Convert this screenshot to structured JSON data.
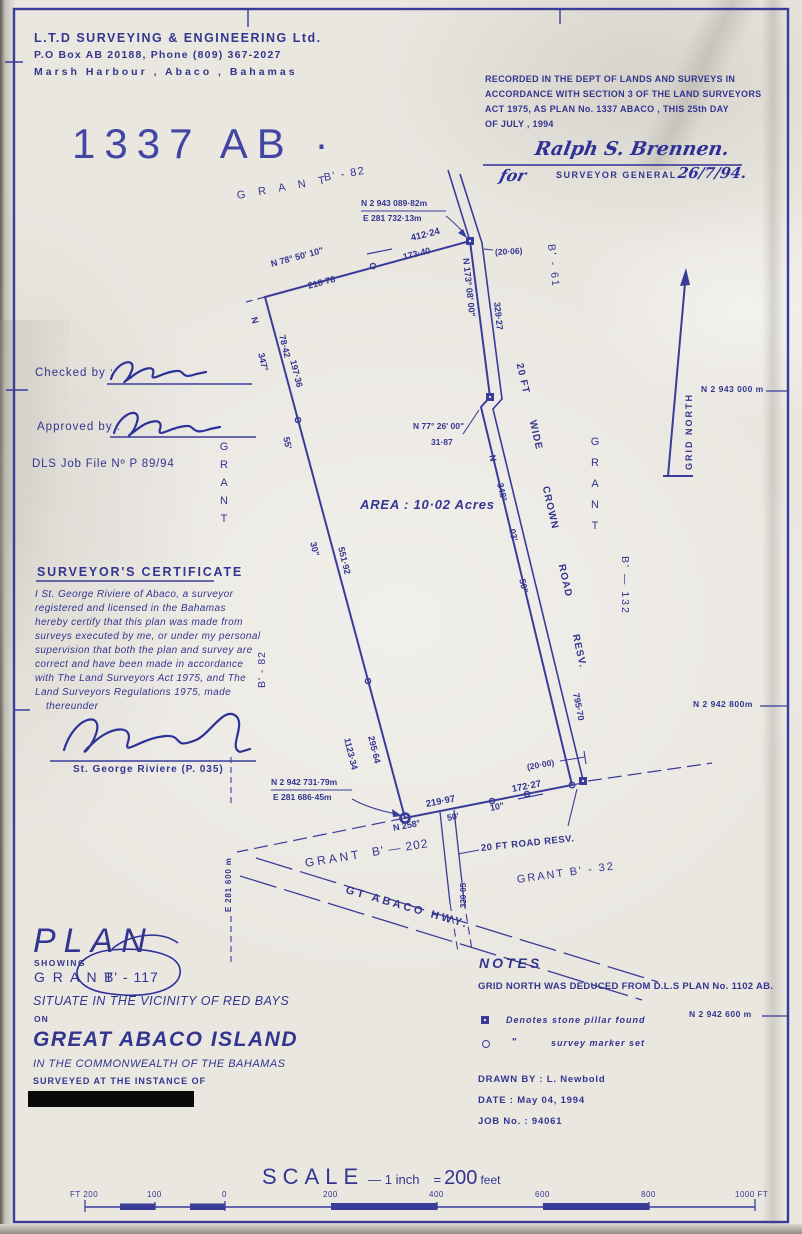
{
  "colors": {
    "ink": "#3a3c9a",
    "text": "#33358f",
    "script": "#2e3198"
  },
  "company": {
    "line1": "L.T.D  SURVEYING  &  ENGINEERING  Ltd.",
    "line2": "P.O Box AB 20188,  Phone  (809) 367-2027",
    "line3": "Marsh  Harbour ,    Abaco   ,   Bahamas"
  },
  "plan_number": "1337 AB ·",
  "recording": {
    "line1": "RECORDED IN THE DEPT  OF LANDS AND SURVEYS  IN",
    "line2": "ACCORDANCE WITH SECTION 3 OF THE LAND SURVEYORS",
    "line3": "ACT 1975, AS PLAN No.  1337    ABACO , THIS 25th DAY",
    "line4": "OF   JULY ,        1994",
    "signature": "Ralph S. Brennen.",
    "for_word": "for",
    "title": "SURVEYOR  GENERAL",
    "date": "26/7/94."
  },
  "approvals": {
    "checked": "Checked by :",
    "approved": "Approved by :",
    "dls": "DLS Job  File Nº  P 89/94"
  },
  "certificate": {
    "title": "SURVEYOR'S  CERTIFICATE",
    "lines": [
      "I St. George Riviere of Abaco, a surveyor",
      "registered and licensed in the Bahamas",
      "hereby certify that this plan was made from",
      "surveys executed by me, or under my personal",
      "supervision that both the plan and survey are",
      "correct and have been made in accordance",
      "with The Land Surveyors Act 1975, and The",
      "Land Surveyors Regulations 1975, made",
      "thereunder"
    ],
    "name": "St. George Riviere  (P. 035)"
  },
  "title_block": {
    "plan": "PLAN",
    "showing": "SHOWING",
    "grant": "G R A N T",
    "grant_no": "B' - 117",
    "situate": "SITUATE IN THE VICINITY OF RED BAYS",
    "on": "ON",
    "island": "GREAT  ABACO  ISLAND",
    "commonwealth": "IN THE COMMONWEALTH  OF THE BAHAMAS",
    "surveyed": "SURVEYED  AT  THE  INSTANCE  OF"
  },
  "notes": {
    "title": "NOTES",
    "line1": "GRID NORTH WAS DEDUCED FROM D.L.S PLAN No. 1102 AB.",
    "legend_pillar": "Denotes stone pillar found",
    "ditto": "\"",
    "legend_marker": "survey marker set",
    "drawn_by": "DRAWN BY :   L. Newbold",
    "date": "DATE          :   May 04,  1994",
    "job": "JOB  No.     :   94061"
  },
  "grid": {
    "n1": "N 2 943 000 m",
    "n2": "N 2 942 800m",
    "n3": "N 2 942 600 m",
    "e1": "E 281 600 m",
    "north": "GRID  NORTH"
  },
  "survey": {
    "area": "AREA : 10·02 Acres",
    "coord_b_n": "N 2 943 089·82m",
    "coord_b_e": "E  281 732·13m",
    "coord_d_n": "N 2 942 731·79m",
    "coord_d_e": "E   281 686·45m",
    "top_bearing": "N 78° 50' 10\"",
    "top_total": "412·24",
    "top_seg": "173·40",
    "top_seg2": "218·78",
    "gap_top": "(20·06)",
    "gap_bottom": "(20·00)",
    "right_bearing": "N 173° 08' 00\"",
    "right_dist": "329·27",
    "jog_bearing": "N 77° 26' 00\"",
    "jog_dist": "31·87",
    "rb_n": "N",
    "rb_deg": "348°",
    "rb_min": "03'",
    "rb_sec": "50\"",
    "right_dist2": "795·70",
    "lb_n": "N",
    "lb_deg": "347°",
    "lb_min": "55'",
    "lb_sec": "30\"",
    "l_seg1": "78·42",
    "l_seg2": "197·36",
    "l_seg3": "551·92",
    "l_seg4": "295·64",
    "l_total": "1123·34",
    "bb_deg": "N 258°",
    "bb_min": "50'",
    "bb_sec": "10\"",
    "b_seg1": "219·97",
    "b_seg2": "172·27",
    "road_w1": "20 FT",
    "road_w2": "WIDE",
    "road_w3": "CROWN",
    "road_w4": "ROAD",
    "road_w5": "RESV.",
    "grant_top": "G R A N T",
    "grant_top_no": "B' - 82",
    "grant_b61": "B' - 61",
    "grant_left": "GRANT",
    "grant_left_no": "B' - 82",
    "grant_right": "GRANT",
    "grant_right_no": "B' — 132",
    "grant_b202": "GRANT",
    "grant_b202_no": "B' — 202",
    "grant_b32": "GRANT   B' - 32",
    "hwy": "GT   ABACO   HWY.",
    "road_resv": "20 FT  ROAD  RESV.",
    "road_dist": "320·05"
  },
  "scale": {
    "parts": [
      "SCALE",
      "— 1 inch",
      "=",
      "200",
      "feet"
    ],
    "ticks": [
      "FT 200",
      "100",
      "0",
      "200",
      "400",
      "600",
      "800",
      "1000 FT"
    ]
  }
}
